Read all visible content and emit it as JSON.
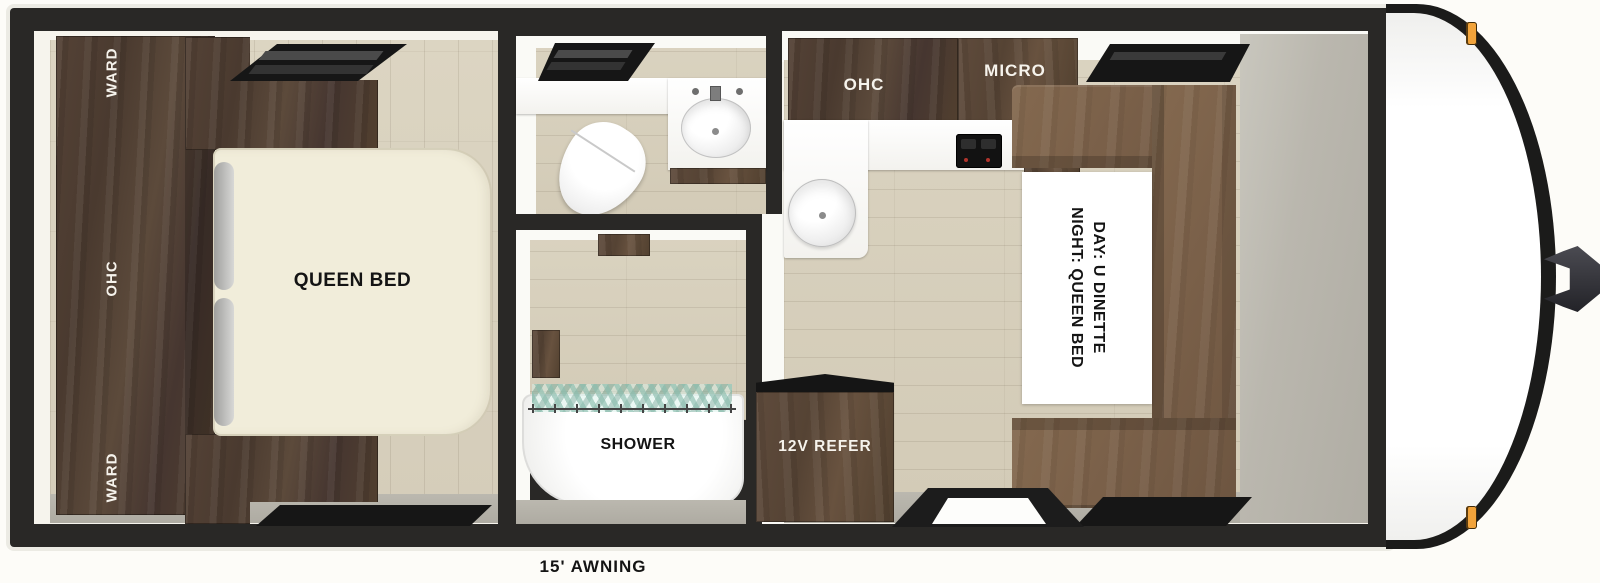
{
  "plan": {
    "awning_label": "15' AWNING",
    "bedroom": {
      "ward_top": "WARD",
      "ohc": "OHC",
      "ward_bottom": "WARD",
      "bed": "QUEEN BED"
    },
    "bathroom": {
      "shower": "SHOWER"
    },
    "kitchen": {
      "ohc": "OHC",
      "micro": "MICRO",
      "refrigerator": "12V REFER"
    },
    "dinette": {
      "day": "DAY: U DINETTE",
      "night": "NIGHT: QUEEN BED"
    },
    "colors": {
      "wall": "#292826",
      "cabinet_wood": "#4e3d31",
      "dinette_wood": "#7a6049",
      "floor_wood": "#d8d1bd",
      "floor_gray": "#b3b0a7",
      "bed_cream": "#f2eeda",
      "marker_light": "#f1a33b"
    }
  }
}
